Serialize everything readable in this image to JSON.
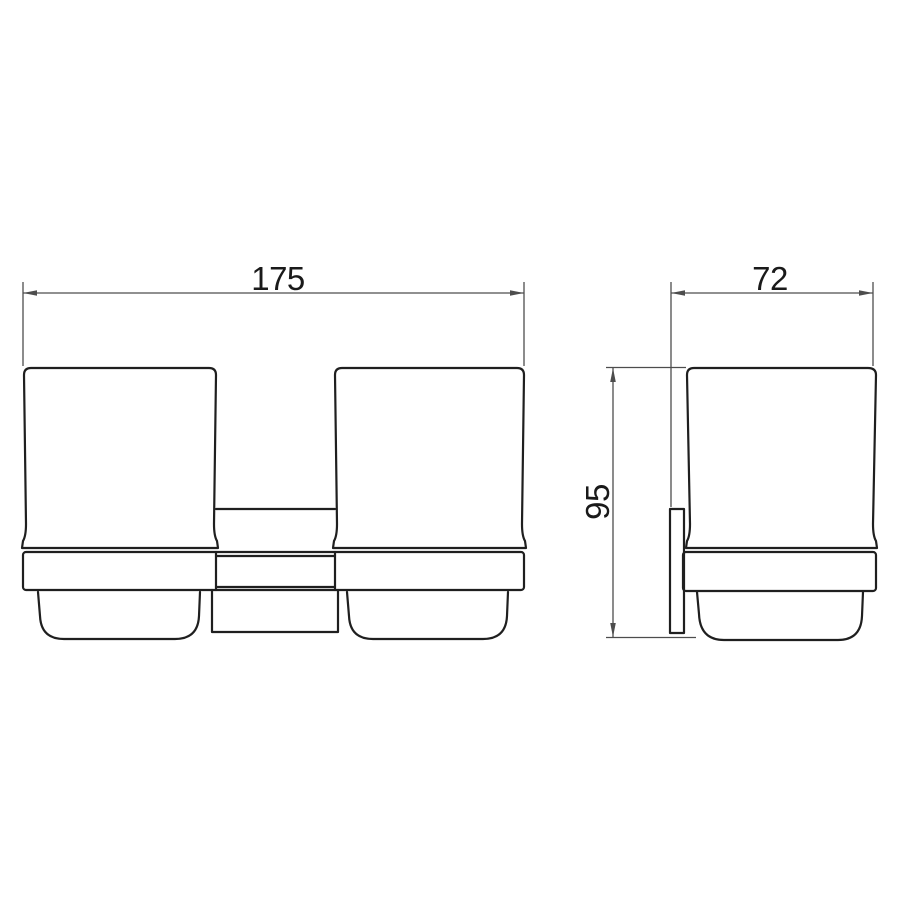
{
  "drawing": {
    "dimension_labels": {
      "overall_width": "175",
      "depth": "72",
      "height": "95"
    },
    "colors": {
      "outline": "#1f1f1f",
      "dimension_line": "#4d4d4d",
      "label_text": "#1a1a1a",
      "background": "#ffffff"
    }
  }
}
